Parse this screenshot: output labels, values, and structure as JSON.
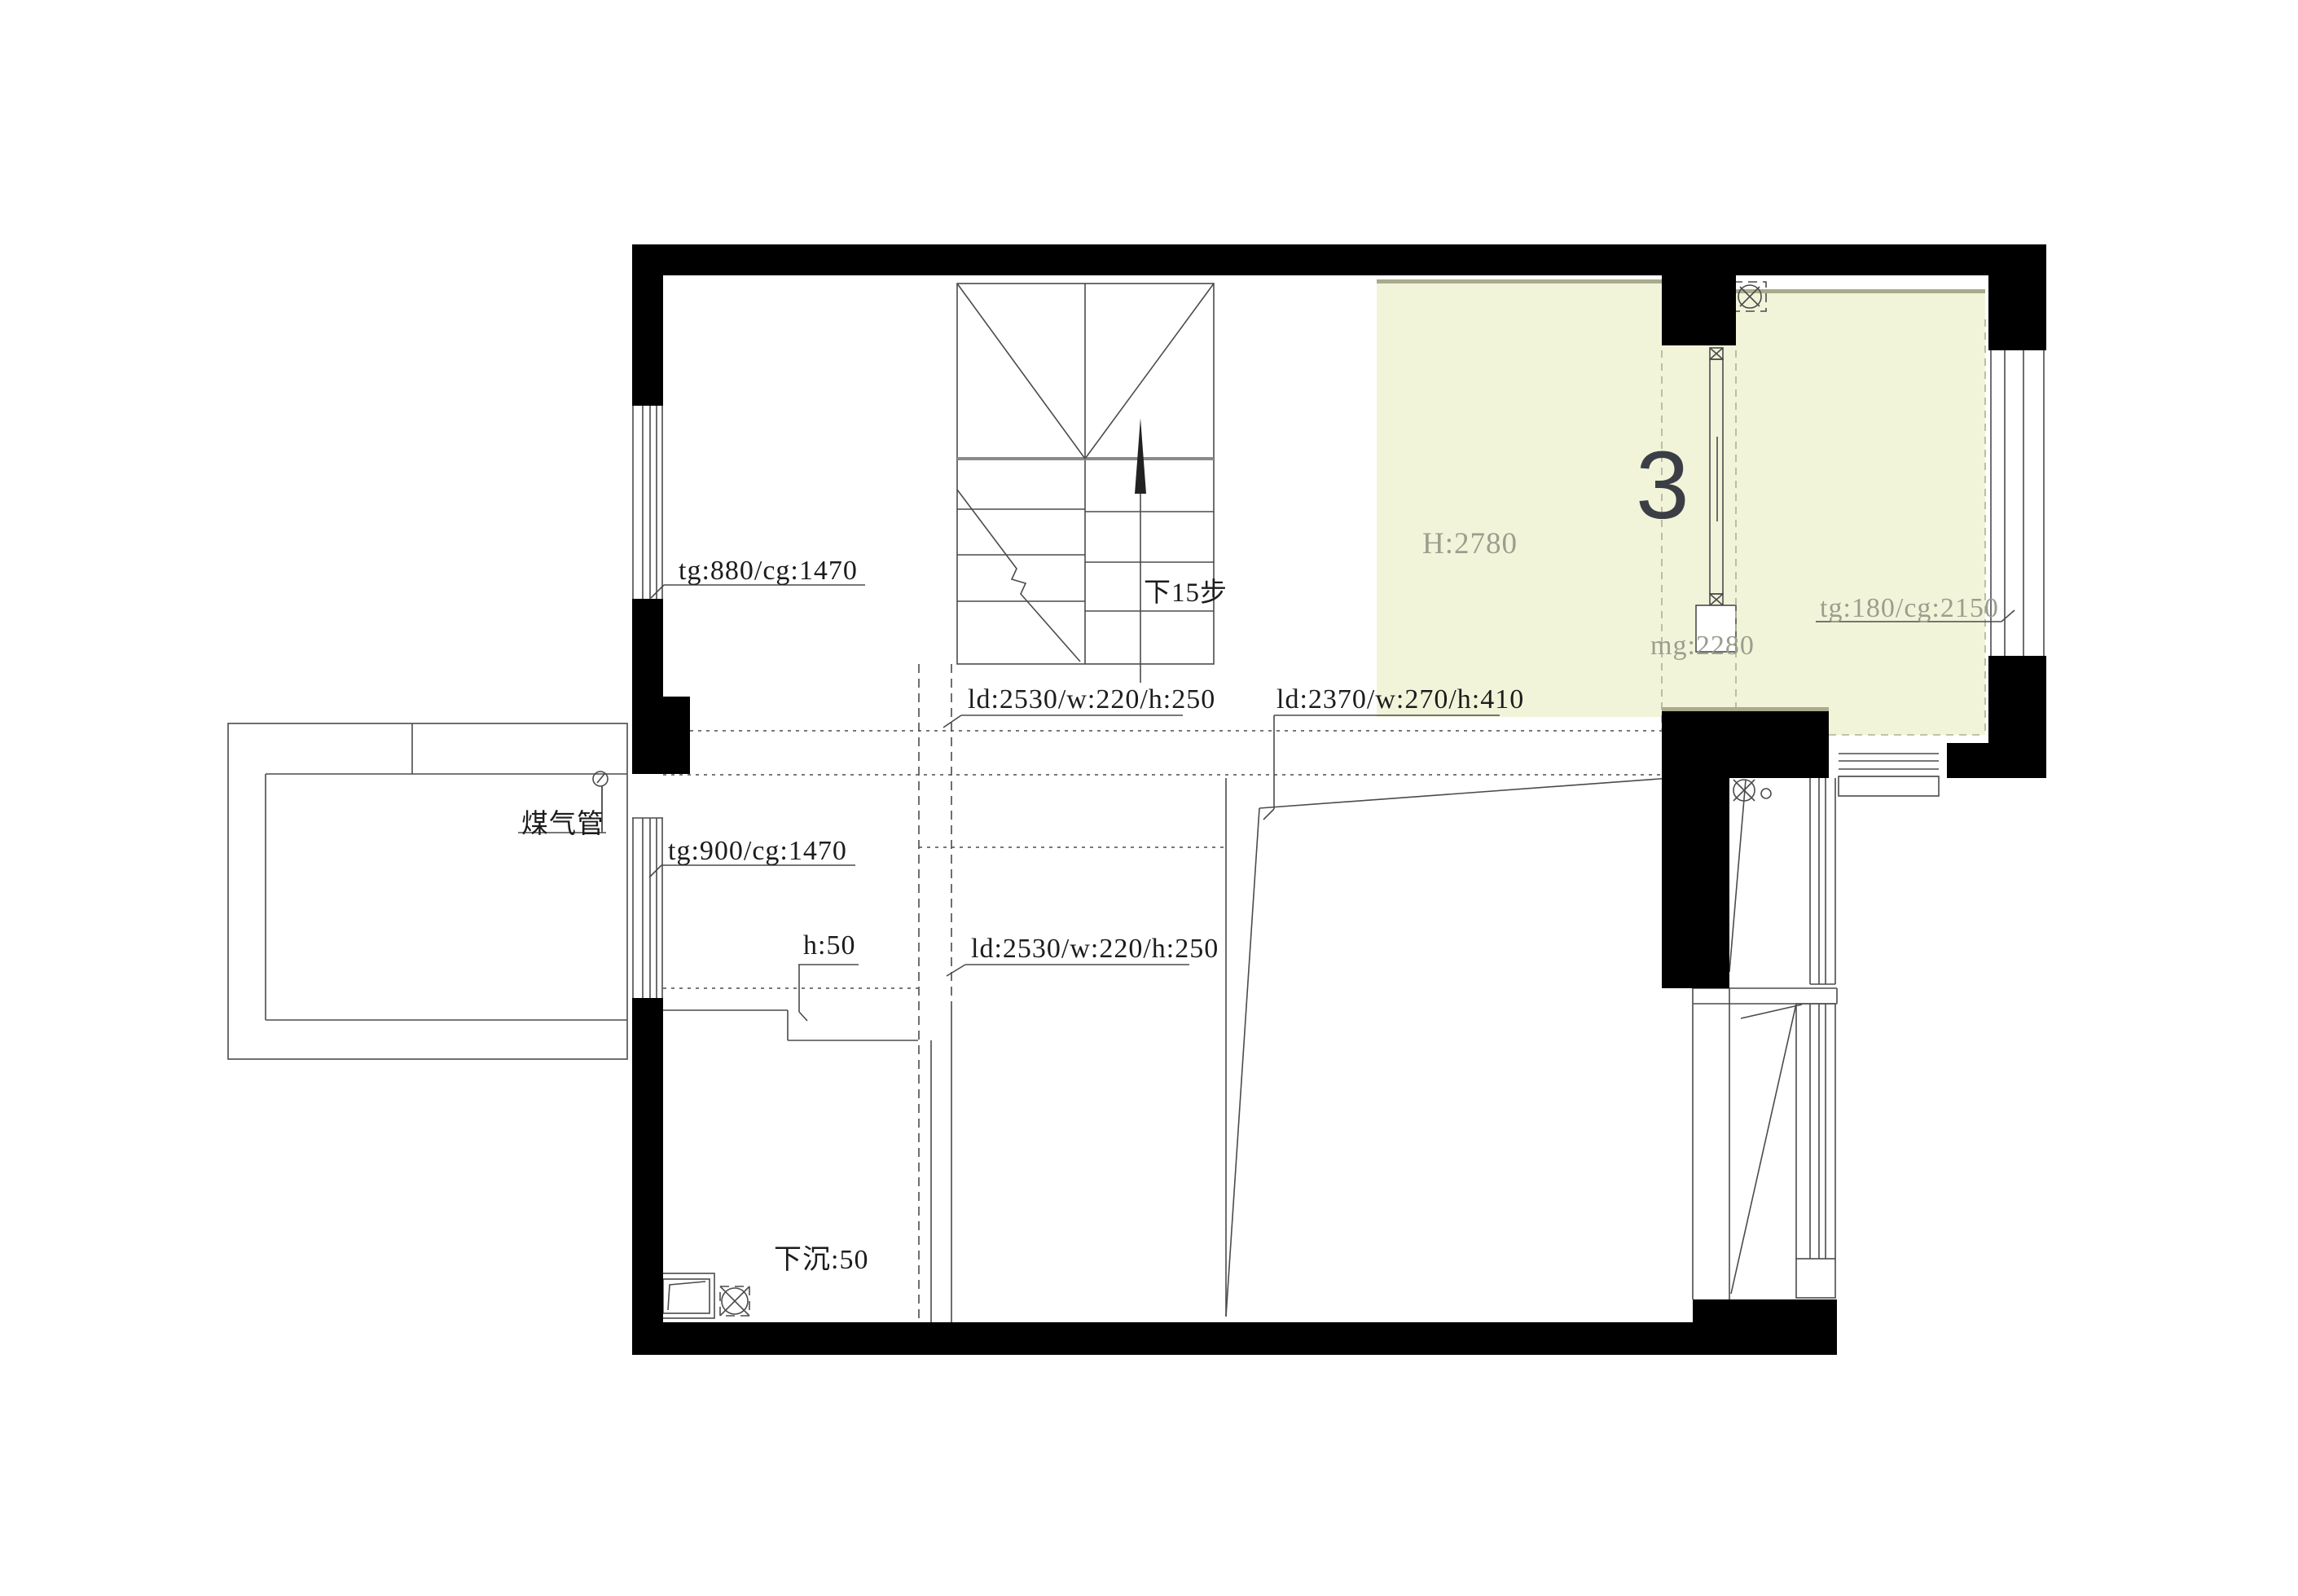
{
  "colors": {
    "highlight": "#f2f4da",
    "highlight_edge": "#a9ac8b",
    "wall": "#000000",
    "line": "#4b4b4b",
    "dim_text": "#9b9e8d",
    "light_dash": "#adb094"
  },
  "room3": {
    "number": "3",
    "ceiling_height": "H:2780",
    "door_height": "mg:2280",
    "window_dim": "tg:180/cg:2150"
  },
  "stairs": {
    "direction_note": "下15步"
  },
  "annotations": {
    "window_upper_left": "tg:880/cg:1470",
    "beam_upper": "ld:2530/w:220/h:250",
    "beam_right_black": "ld:2370/w:",
    "beam_right_gray": "270/h:410",
    "gas_pipe": "煤气管",
    "window_mid_left": "tg:900/cg:1470",
    "step_height": "h:50",
    "beam_lower": "ld:2530/w:220/h:250",
    "sunken_floor": "下沉:50"
  },
  "icons": {
    "exhaust_fan": "circle-with-x",
    "floor_drain": "circle-with-x-dashed-box",
    "gas_pipe_symbol": "small-circle-with-leader",
    "stairs_up_arrow": "elongated-solid-arrow"
  }
}
